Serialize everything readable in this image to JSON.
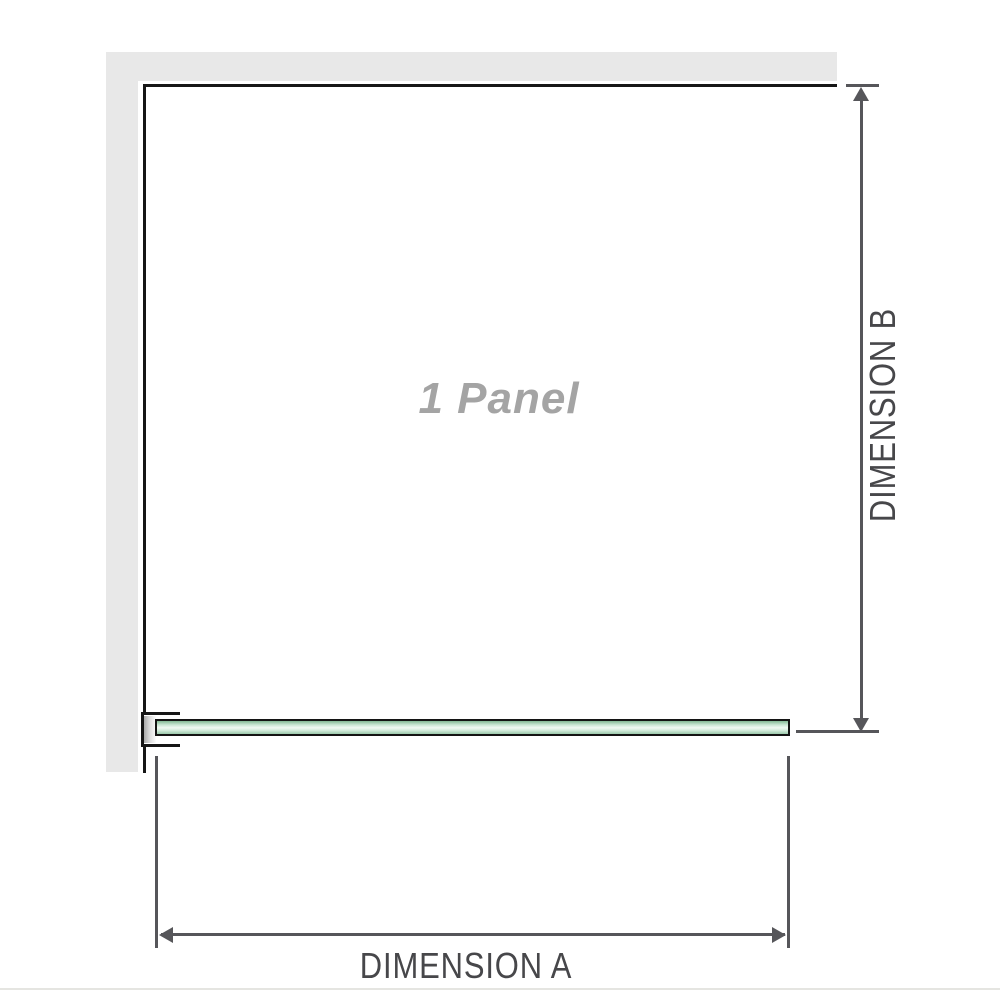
{
  "diagram": {
    "panel_label": "1 Panel",
    "dimension_a_label": "DIMENSION A",
    "dimension_b_label": "DIMENSION B"
  },
  "icons": {
    "dimension_a_arrows": "double-headed-horizontal-arrow",
    "dimension_b_arrows": "double-headed-vertical-arrow"
  },
  "colors": {
    "background": "#ffffff",
    "wall_fill": "#e8e8e8",
    "panel_outline": "#161616",
    "dimension_lines": "#56565a",
    "dimension_text": "#47474a",
    "panel_label_text": "#a4a4a4",
    "glass_edge_green": "#82b893",
    "glass_mid_green": "#f0f9f3",
    "bracket_pad_gray": "#a9a9a9",
    "bottom_divider": "#e5e5e1"
  }
}
